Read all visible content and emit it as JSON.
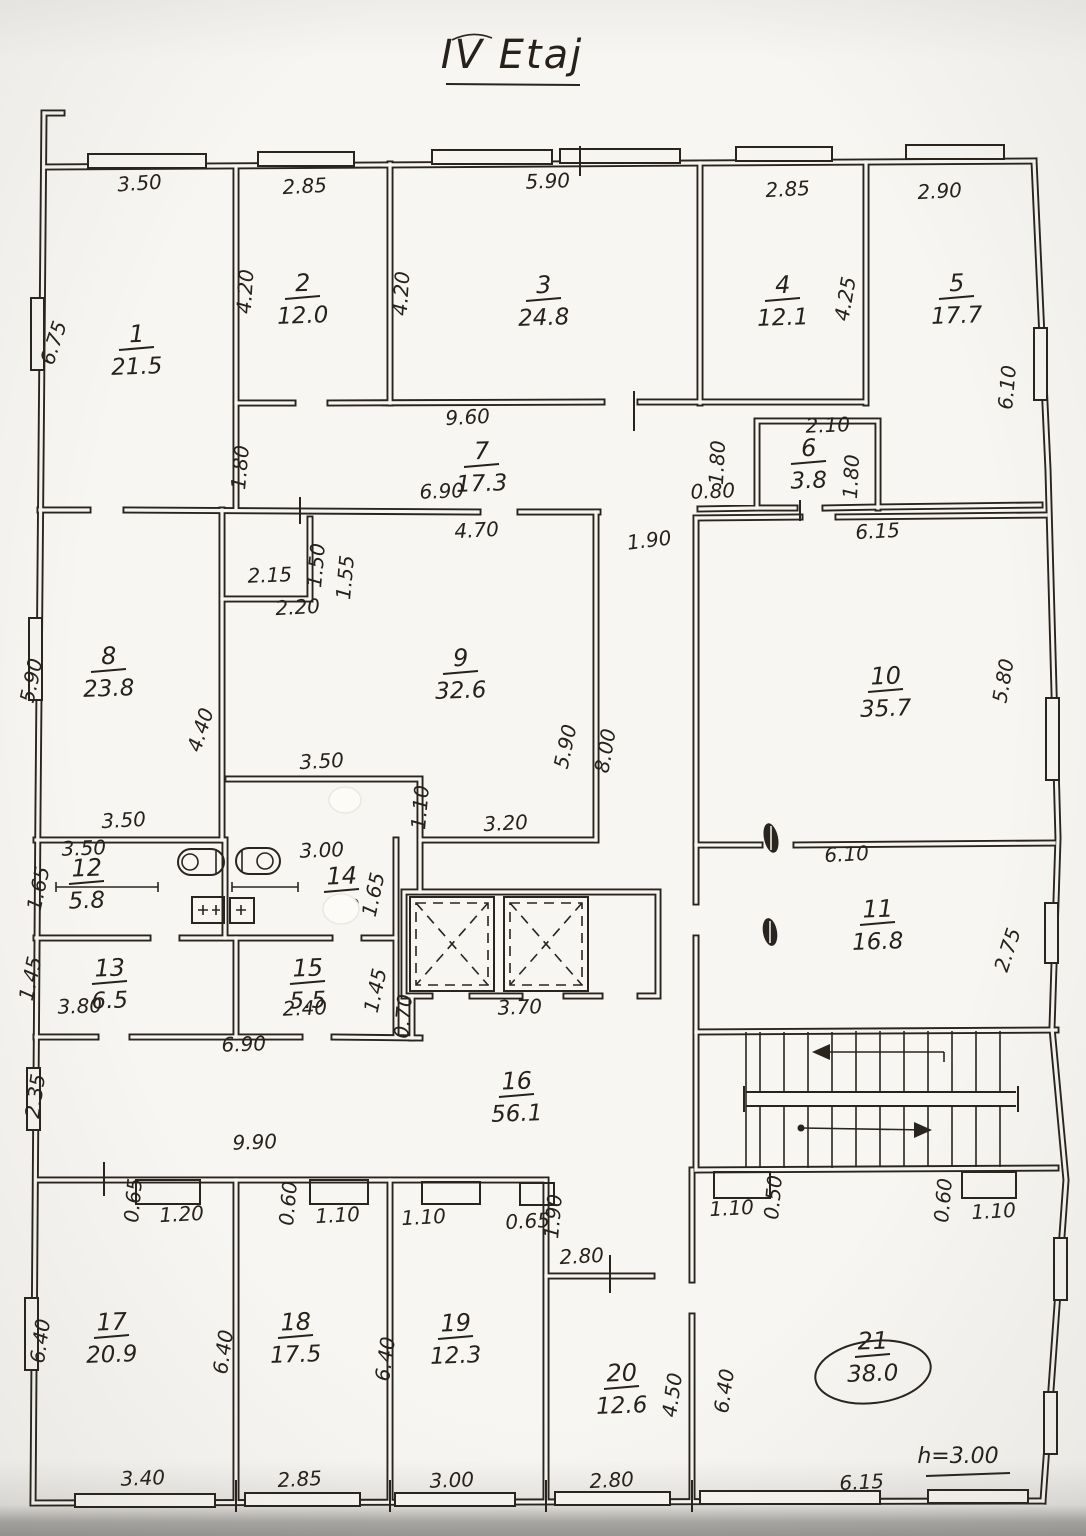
{
  "title": {
    "text": "IV Etaj"
  },
  "note": {
    "text": "h=3.00"
  },
  "colors": {
    "ink": "#2a241e",
    "paper": "#f7f5f1"
  },
  "rooms": [
    {
      "n": "1",
      "area": "21.5",
      "x": 137,
      "y": 342,
      "circled": false
    },
    {
      "n": "2",
      "area": "12.0",
      "x": 303,
      "y": 291,
      "circled": false
    },
    {
      "n": "3",
      "area": "24.8",
      "x": 544,
      "y": 293,
      "circled": false
    },
    {
      "n": "4",
      "area": "12.1",
      "x": 783,
      "y": 293,
      "circled": false
    },
    {
      "n": "5",
      "area": "17.7",
      "x": 957,
      "y": 291,
      "circled": false
    },
    {
      "n": "6",
      "area": "3.8",
      "x": 809,
      "y": 456,
      "circled": false
    },
    {
      "n": "7",
      "area": "17.3",
      "x": 482,
      "y": 459,
      "circled": false
    },
    {
      "n": "8",
      "area": "23.8",
      "x": 109,
      "y": 664,
      "circled": false
    },
    {
      "n": "9",
      "area": "32.6",
      "x": 461,
      "y": 666,
      "circled": false
    },
    {
      "n": "10",
      "area": "35.7",
      "x": 886,
      "y": 684,
      "circled": false
    },
    {
      "n": "11",
      "area": "16.8",
      "x": 878,
      "y": 917,
      "circled": false
    },
    {
      "n": "12",
      "area": "5.8",
      "x": 87,
      "y": 876,
      "circled": false
    },
    {
      "n": "13",
      "area": "6.5",
      "x": 110,
      "y": 976,
      "circled": false
    },
    {
      "n": "14",
      "area": "5.0",
      "x": 342,
      "y": 884,
      "circled": false
    },
    {
      "n": "15",
      "area": "5.5",
      "x": 308,
      "y": 976,
      "circled": false
    },
    {
      "n": "16",
      "area": "56.1",
      "x": 517,
      "y": 1089,
      "circled": false
    },
    {
      "n": "17",
      "area": "20.9",
      "x": 112,
      "y": 1330,
      "circled": false
    },
    {
      "n": "18",
      "area": "17.5",
      "x": 296,
      "y": 1330,
      "circled": false
    },
    {
      "n": "19",
      "area": "12.3",
      "x": 456,
      "y": 1331,
      "circled": false
    },
    {
      "n": "20",
      "area": "12.6",
      "x": 622,
      "y": 1381,
      "circled": false
    },
    {
      "n": "21",
      "area": "38.0",
      "x": 873,
      "y": 1349,
      "circled": true
    }
  ],
  "dims": [
    {
      "t": "3.50",
      "x": 140,
      "y": 190,
      "r": -4
    },
    {
      "t": "2.85",
      "x": 305,
      "y": 193,
      "r": -3
    },
    {
      "t": "5.90",
      "x": 548,
      "y": 188,
      "r": -2
    },
    {
      "t": "2.85",
      "x": 788,
      "y": 196,
      "r": -3
    },
    {
      "t": "2.90",
      "x": 940,
      "y": 198,
      "r": -3
    },
    {
      "t": "6.75",
      "x": 60,
      "y": 345,
      "r": -72
    },
    {
      "t": "4.20",
      "x": 252,
      "y": 292,
      "r": -86
    },
    {
      "t": "4.20",
      "x": 408,
      "y": 294,
      "r": -86
    },
    {
      "t": "4.25",
      "x": 852,
      "y": 300,
      "r": -80
    },
    {
      "t": "6.10",
      "x": 1014,
      "y": 388,
      "r": -85
    },
    {
      "t": "9.60",
      "x": 468,
      "y": 424,
      "r": -3
    },
    {
      "t": "1.80",
      "x": 247,
      "y": 468,
      "r": -85
    },
    {
      "t": "6.90",
      "x": 442,
      "y": 498,
      "r": -2
    },
    {
      "t": "2.10",
      "x": 828,
      "y": 432,
      "r": -2
    },
    {
      "t": "1.80",
      "x": 724,
      "y": 463,
      "r": -87
    },
    {
      "t": "1.80",
      "x": 858,
      "y": 477,
      "r": -87
    },
    {
      "t": "0.80",
      "x": 713,
      "y": 498,
      "r": -2
    },
    {
      "t": "6.15",
      "x": 878,
      "y": 538,
      "r": -3
    },
    {
      "t": "1.90",
      "x": 650,
      "y": 547,
      "r": -7
    },
    {
      "t": "4.70",
      "x": 477,
      "y": 537,
      "r": -3
    },
    {
      "t": "2.15",
      "x": 270,
      "y": 582,
      "r": -2
    },
    {
      "t": "1.50",
      "x": 323,
      "y": 566,
      "r": -85
    },
    {
      "t": "1.55",
      "x": 352,
      "y": 578,
      "r": -85
    },
    {
      "t": "2.20",
      "x": 298,
      "y": 614,
      "r": -3
    },
    {
      "t": "5.90",
      "x": 38,
      "y": 682,
      "r": -78
    },
    {
      "t": "4.40",
      "x": 207,
      "y": 732,
      "r": -72
    },
    {
      "t": "5.90",
      "x": 572,
      "y": 748,
      "r": -78
    },
    {
      "t": "8.00",
      "x": 612,
      "y": 752,
      "r": -80
    },
    {
      "t": "5.80",
      "x": 1010,
      "y": 682,
      "r": -80
    },
    {
      "t": "3.50",
      "x": 322,
      "y": 768,
      "r": -3
    },
    {
      "t": "1.10",
      "x": 427,
      "y": 808,
      "r": -85
    },
    {
      "t": "3.20",
      "x": 506,
      "y": 830,
      "r": -3
    },
    {
      "t": "3.50",
      "x": 124,
      "y": 827,
      "r": -3
    },
    {
      "t": "3.50",
      "x": 84,
      "y": 855,
      "r": -2
    },
    {
      "t": "3.00",
      "x": 322,
      "y": 857,
      "r": -2
    },
    {
      "t": "6.10",
      "x": 847,
      "y": 861,
      "r": -3
    },
    {
      "t": "1.65",
      "x": 45,
      "y": 890,
      "r": -78
    },
    {
      "t": "1.65",
      "x": 380,
      "y": 896,
      "r": -78
    },
    {
      "t": "2.75",
      "x": 1014,
      "y": 952,
      "r": -72
    },
    {
      "t": "1.45",
      "x": 37,
      "y": 980,
      "r": -78
    },
    {
      "t": "1.45",
      "x": 382,
      "y": 992,
      "r": -78
    },
    {
      "t": "3.80",
      "x": 80,
      "y": 1013,
      "r": -2
    },
    {
      "t": "2.40",
      "x": 305,
      "y": 1015,
      "r": -2
    },
    {
      "t": "0.70",
      "x": 410,
      "y": 1017,
      "r": -85
    },
    {
      "t": "3.70",
      "x": 520,
      "y": 1014,
      "r": -2
    },
    {
      "t": "6.90",
      "x": 244,
      "y": 1051,
      "r": -2
    },
    {
      "t": "9.90",
      "x": 255,
      "y": 1149,
      "r": -2
    },
    {
      "t": "2.35",
      "x": 42,
      "y": 1097,
      "r": -82
    },
    {
      "t": "0.65",
      "x": 140,
      "y": 1201,
      "r": -85
    },
    {
      "t": "1.20",
      "x": 182,
      "y": 1221,
      "r": -3
    },
    {
      "t": "0.60",
      "x": 295,
      "y": 1204,
      "r": -85
    },
    {
      "t": "1.10",
      "x": 338,
      "y": 1222,
      "r": -3
    },
    {
      "t": "1.10",
      "x": 424,
      "y": 1224,
      "r": -3
    },
    {
      "t": "0.65",
      "x": 528,
      "y": 1228,
      "r": -3
    },
    {
      "t": "1.90",
      "x": 560,
      "y": 1217,
      "r": -85
    },
    {
      "t": "2.80",
      "x": 582,
      "y": 1263,
      "r": -3
    },
    {
      "t": "1.10",
      "x": 732,
      "y": 1215,
      "r": -3
    },
    {
      "t": "0.50",
      "x": 780,
      "y": 1198,
      "r": -85
    },
    {
      "t": "0.60",
      "x": 950,
      "y": 1201,
      "r": -85
    },
    {
      "t": "1.10",
      "x": 994,
      "y": 1218,
      "r": -3
    },
    {
      "t": "6.40",
      "x": 47,
      "y": 1342,
      "r": -82
    },
    {
      "t": "6.40",
      "x": 230,
      "y": 1353,
      "r": -82
    },
    {
      "t": "6.40",
      "x": 392,
      "y": 1360,
      "r": -82
    },
    {
      "t": "4.50",
      "x": 679,
      "y": 1396,
      "r": -82
    },
    {
      "t": "6.40",
      "x": 731,
      "y": 1392,
      "r": -82
    },
    {
      "t": "3.40",
      "x": 143,
      "y": 1485,
      "r": -2
    },
    {
      "t": "2.85",
      "x": 300,
      "y": 1486,
      "r": -3
    },
    {
      "t": "3.00",
      "x": 452,
      "y": 1487,
      "r": -2
    },
    {
      "t": "2.80",
      "x": 612,
      "y": 1487,
      "r": -3
    },
    {
      "t": "6.15",
      "x": 862,
      "y": 1489,
      "r": -3
    }
  ]
}
